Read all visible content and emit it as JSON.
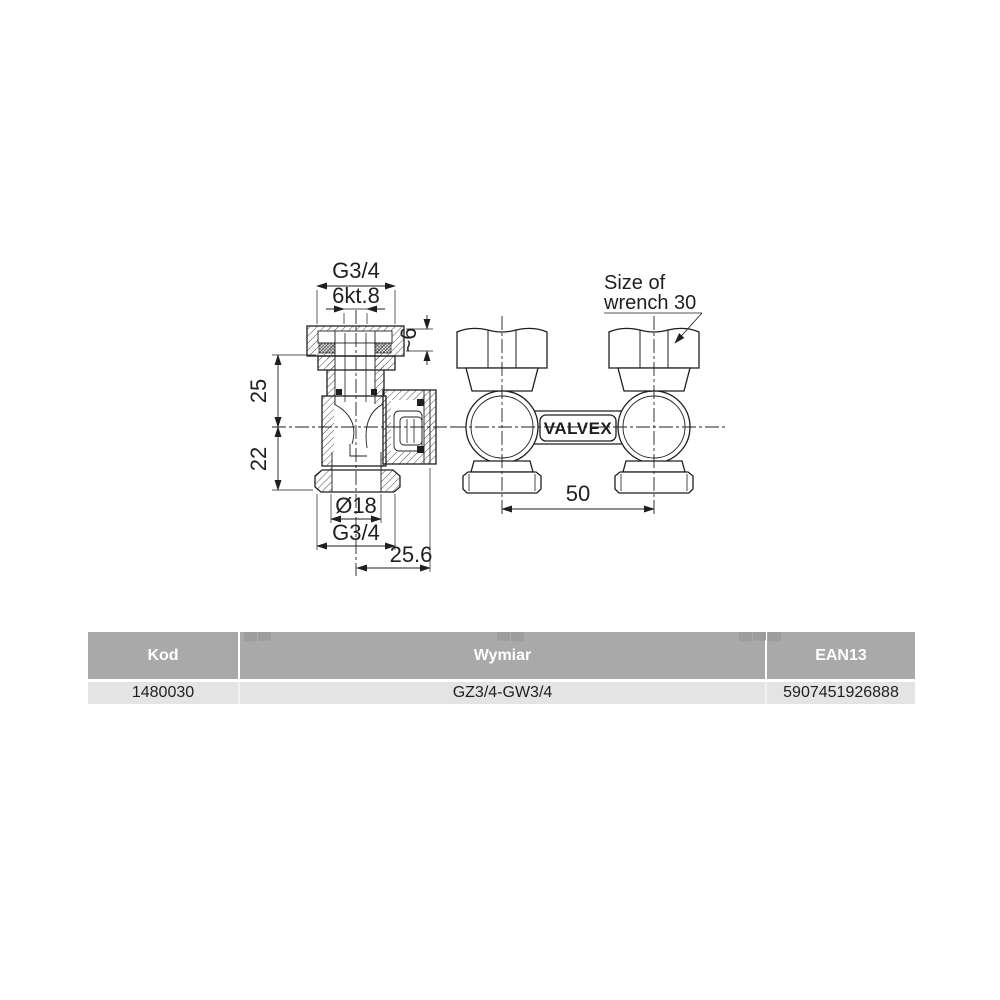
{
  "page": {
    "background": "#ffffff",
    "line_color": "#1f1f1f"
  },
  "drawing": {
    "section_view": {
      "dim_g34_top": "G3/4",
      "dim_hex": "6kt.8",
      "dim_approx6": "~6",
      "dim_25": "25",
      "dim_22": "22",
      "dim_dia18": "Ø18",
      "dim_g34_bottom": "G3/4",
      "dim_256": "25.6"
    },
    "front_view": {
      "note_line1": "Size of",
      "note_line2": "wrench 30",
      "brand": "VALVEX",
      "dim_50": "50"
    }
  },
  "table": {
    "colors": {
      "header_bg": "#a9a9a9",
      "header_text": "#ffffff",
      "row_bg": "#e4e4e4",
      "row_text": "#1f1f1f",
      "tab_artifact": "#9d9d9d"
    },
    "columns": [
      {
        "key": "kod",
        "label": "Kod"
      },
      {
        "key": "wymiar",
        "label": "Wymiar"
      },
      {
        "key": "ean",
        "label": "EAN13"
      }
    ],
    "rows": [
      {
        "kod": "1480030",
        "wymiar": "GZ3/4-GW3/4",
        "ean": "5907451926888"
      }
    ]
  }
}
